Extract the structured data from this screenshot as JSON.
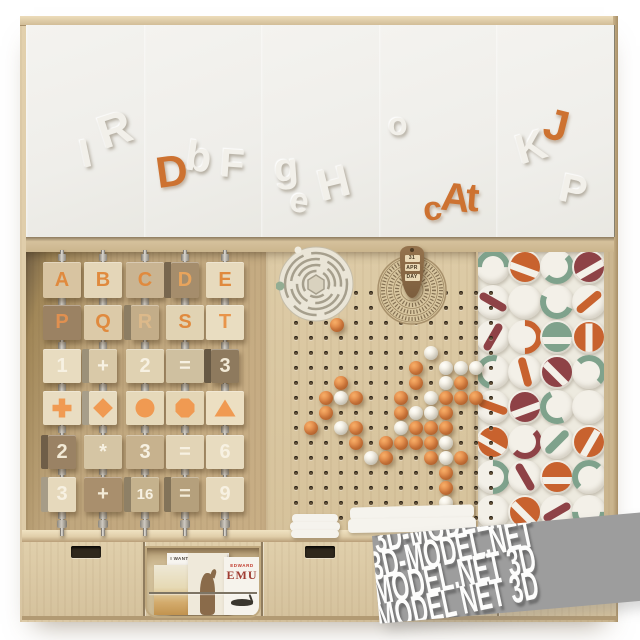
{
  "source_label": "3D-MODEL.NET",
  "watermark": {
    "lines": [
      "T 3D-MODEL.N",
      "3D-MODEL.NET",
      "D-MODEL.NET 3D",
      "MODEL NET 3D"
    ]
  },
  "colors": {
    "accent_orange": "#cd7231",
    "wood_light": "#d6c3a0",
    "wood_mid": "#bfa67d",
    "door_white": "#efeeea",
    "ball_orange": "#dd8040",
    "ball_white": "#efe9da"
  },
  "doors": {
    "count": 5,
    "letters": [
      {
        "ch": "I",
        "x": 80,
        "y": 134,
        "rot": -12,
        "color": "white",
        "size": 40
      },
      {
        "ch": "R",
        "x": 98,
        "y": 106,
        "rot": -18,
        "color": "white",
        "size": 46
      },
      {
        "ch": "D",
        "x": 156,
        "y": 150,
        "rot": -8,
        "color": "orange",
        "size": 44
      },
      {
        "ch": "b",
        "x": 186,
        "y": 136,
        "rot": 8,
        "color": "white",
        "size": 42
      },
      {
        "ch": "F",
        "x": 220,
        "y": 144,
        "rot": 4,
        "color": "white",
        "size": 40
      },
      {
        "ch": "g",
        "x": 274,
        "y": 148,
        "rot": -4,
        "color": "white",
        "size": 40
      },
      {
        "ch": "e",
        "x": 290,
        "y": 184,
        "rot": 10,
        "color": "white",
        "size": 34
      },
      {
        "ch": "H",
        "x": 318,
        "y": 162,
        "rot": -14,
        "color": "white",
        "size": 44
      },
      {
        "ch": "o",
        "x": 388,
        "y": 108,
        "rot": 0,
        "color": "white",
        "size": 32
      },
      {
        "ch": "c",
        "x": 423,
        "y": 192,
        "rot": -6,
        "color": "orange",
        "size": 34
      },
      {
        "ch": "A",
        "x": 441,
        "y": 178,
        "rot": 6,
        "color": "orange",
        "size": 40
      },
      {
        "ch": "t",
        "x": 466,
        "y": 178,
        "rot": 4,
        "color": "orange",
        "size": 40
      },
      {
        "ch": "K",
        "x": 516,
        "y": 126,
        "rot": -16,
        "color": "white",
        "size": 42
      },
      {
        "ch": "J",
        "x": 544,
        "y": 104,
        "rot": 14,
        "color": "orange",
        "size": 44
      },
      {
        "ch": "P",
        "x": 560,
        "y": 170,
        "rot": 12,
        "color": "white",
        "size": 40
      }
    ]
  },
  "abacus": {
    "rod_x": [
      62,
      103,
      145,
      185,
      225
    ],
    "sleeve_y": [
      238,
      282,
      326,
      368,
      410,
      452,
      496
    ],
    "nut_y": 504,
    "shape_color": "#f09a52",
    "rows": [
      {
        "y": 262,
        "h": 36,
        "items": [
          {
            "ch": "A",
            "bg": "#d8c4a1",
            "fg": "#e08a3e"
          },
          {
            "ch": "B",
            "bg": "#e4d6b8",
            "fg": "#e08a3e"
          },
          {
            "ch": "C",
            "bg": "#c9b492",
            "fg": "#e08a3e"
          },
          {
            "ch": "D",
            "bg": "#a58d6c",
            "fg": "#e8a45c",
            "turn": true
          },
          {
            "ch": "E",
            "bg": "#e7dabd",
            "fg": "#e08a3e"
          }
        ]
      },
      {
        "y": 305,
        "h": 35,
        "items": [
          {
            "ch": "P",
            "bg": "#9b8263",
            "fg": "#e09050"
          },
          {
            "ch": "Q",
            "bg": "#dccaa8",
            "fg": "#e08a3e"
          },
          {
            "ch": "R",
            "bg": "#c3ad89",
            "fg": "#dcb98a",
            "turn": true
          },
          {
            "ch": "S",
            "bg": "#e1d3b3",
            "fg": "#e08a3e"
          },
          {
            "ch": "T",
            "bg": "#e9ddc1",
            "fg": "#e8944a"
          }
        ]
      },
      {
        "y": 349,
        "h": 34,
        "items": [
          {
            "ch": "1",
            "bg": "#e8dcc0",
            "fg": "#f7f1e2"
          },
          {
            "ch": "+",
            "bg": "#d9c9a8",
            "fg": "#f7f1e2",
            "turn": true
          },
          {
            "ch": "2",
            "bg": "#e0d2b2",
            "fg": "#f7f1e2"
          },
          {
            "ch": "=",
            "bg": "#cfc0a0",
            "fg": "#f7f1e2"
          },
          {
            "ch": "3",
            "bg": "#8e7a5e",
            "fg": "#f2ead6",
            "turn": true
          }
        ]
      },
      {
        "y": 391,
        "h": 34,
        "items": [
          {
            "shape": "cross",
            "bg": "#e9ddc2"
          },
          {
            "shape": "diamond",
            "bg": "#e8dcc0",
            "turn": true
          },
          {
            "shape": "circle",
            "bg": "#e6d9ba"
          },
          {
            "shape": "octagon",
            "bg": "#e4d6b6"
          },
          {
            "shape": "triangle",
            "bg": "#ecdfc2"
          }
        ]
      },
      {
        "y": 435,
        "h": 34,
        "items": [
          {
            "ch": "2",
            "bg": "#9a8264",
            "fg": "#f2ead6",
            "turn": true
          },
          {
            "ch": "*",
            "bg": "#d5c5a4",
            "fg": "#f7f1e2"
          },
          {
            "ch": "3",
            "bg": "#c7b28e",
            "fg": "#f7f1e2"
          },
          {
            "ch": "=",
            "bg": "#e2d4b6",
            "fg": "#f7f1e2"
          },
          {
            "ch": "6",
            "bg": "#e8dcc0",
            "fg": "#f7f1e2"
          }
        ]
      },
      {
        "y": 477,
        "h": 35,
        "items": [
          {
            "ch": "3",
            "bg": "#e6d9bc",
            "fg": "#f7f1e2",
            "turn": true
          },
          {
            "ch": "+",
            "bg": "#a98f6d",
            "fg": "#f2ead6"
          },
          {
            "ch": "16",
            "bg": "#c5b28d",
            "fg": "#f7f1e2",
            "turn": true,
            "small": true
          },
          {
            "ch": "=",
            "bg": "#b5a07c",
            "fg": "#f2ead6",
            "turn": true
          },
          {
            "ch": "9",
            "bg": "#e6d9bc",
            "fg": "#f7f1e2"
          }
        ]
      }
    ]
  },
  "pegboard": {
    "cols": 14,
    "rows": 16,
    "origin_x": 276,
    "origin_y": 291,
    "spacing": 15,
    "balls": [
      [
        4,
        9,
        "w"
      ],
      [
        5,
        8,
        "o"
      ],
      [
        5,
        10,
        "w"
      ],
      [
        5,
        11,
        "w"
      ],
      [
        5,
        12,
        "w"
      ],
      [
        6,
        3,
        "o"
      ],
      [
        6,
        8,
        "o"
      ],
      [
        6,
        10,
        "w"
      ],
      [
        6,
        11,
        "o"
      ],
      [
        7,
        2,
        "o"
      ],
      [
        7,
        3,
        "w"
      ],
      [
        7,
        4,
        "o"
      ],
      [
        7,
        7,
        "o"
      ],
      [
        7,
        9,
        "w"
      ],
      [
        7,
        10,
        "o"
      ],
      [
        7,
        11,
        "o"
      ],
      [
        7,
        12,
        "o"
      ],
      [
        8,
        2,
        "o"
      ],
      [
        8,
        7,
        "o"
      ],
      [
        8,
        8,
        "w"
      ],
      [
        8,
        9,
        "w"
      ],
      [
        8,
        10,
        "o"
      ],
      [
        9,
        1,
        "o"
      ],
      [
        9,
        3,
        "w"
      ],
      [
        9,
        4,
        "o"
      ],
      [
        9,
        7,
        "w"
      ],
      [
        9,
        8,
        "o"
      ],
      [
        9,
        9,
        "o"
      ],
      [
        9,
        10,
        "o"
      ],
      [
        10,
        4,
        "o"
      ],
      [
        10,
        6,
        "o"
      ],
      [
        10,
        7,
        "o"
      ],
      [
        10,
        8,
        "o"
      ],
      [
        10,
        9,
        "o"
      ],
      [
        10,
        10,
        "w"
      ],
      [
        11,
        5,
        "w"
      ],
      [
        11,
        6,
        "o"
      ],
      [
        11,
        9,
        "o"
      ],
      [
        11,
        10,
        "w"
      ],
      [
        11,
        11,
        "o"
      ],
      [
        12,
        10,
        "o"
      ],
      [
        13,
        10,
        "o"
      ],
      [
        14,
        10,
        "w"
      ]
    ],
    "loose_ball": {
      "x": 330,
      "y": 318,
      "color": "o"
    },
    "green_peg_color": "#93ad93"
  },
  "dial": {
    "windows": [
      "31",
      "APR",
      "DAY"
    ]
  },
  "pattern": {
    "palette": {
      "o": "#c8622e",
      "m": "#8e4246",
      "g": "#7fa28c"
    },
    "cols": 4,
    "rows": 8,
    "cell_w": 32,
    "cell_h": 35,
    "tiles": [
      {
        "t": "arc",
        "c": "g",
        "r": -45
      },
      {
        "t": "disc",
        "c": "o",
        "r": 20
      },
      {
        "t": "arc",
        "c": "g",
        "r": 90
      },
      {
        "t": "disc",
        "c": "m",
        "r": -30
      },
      {
        "t": "bar",
        "c": "m",
        "r": 30
      },
      {
        "t": "plain"
      },
      {
        "t": "arc",
        "c": "g",
        "r": 160
      },
      {
        "t": "bar",
        "c": "o",
        "r": -40
      },
      {
        "t": "bar",
        "c": "m",
        "r": -60
      },
      {
        "t": "arc",
        "c": "o",
        "r": 45
      },
      {
        "t": "disc",
        "c": "g",
        "r": 0
      },
      {
        "t": "disc",
        "c": "o",
        "r": 90
      },
      {
        "t": "arc",
        "c": "g",
        "r": -120
      },
      {
        "t": "bar",
        "c": "o",
        "r": 75
      },
      {
        "t": "disc",
        "c": "m",
        "r": 45
      },
      {
        "t": "arc",
        "c": "g",
        "r": 0
      },
      {
        "t": "bar",
        "c": "o",
        "r": 20
      },
      {
        "t": "disc",
        "c": "m",
        "r": -20
      },
      {
        "t": "arc",
        "c": "g",
        "r": 200
      },
      {
        "t": "plain"
      },
      {
        "t": "disc",
        "c": "o",
        "r": 30
      },
      {
        "t": "arc",
        "c": "m",
        "r": 90
      },
      {
        "t": "bar",
        "c": "g",
        "r": -45
      },
      {
        "t": "disc",
        "c": "o",
        "r": -60
      },
      {
        "t": "arc",
        "c": "g",
        "r": 45
      },
      {
        "t": "bar",
        "c": "m",
        "r": 60
      },
      {
        "t": "disc",
        "c": "o",
        "r": 0
      },
      {
        "t": "arc",
        "c": "g",
        "r": -90
      },
      {
        "t": "plain"
      },
      {
        "t": "disc",
        "c": "o",
        "r": 45
      },
      {
        "t": "bar",
        "c": "m",
        "r": -30
      },
      {
        "t": "arc",
        "c": "g",
        "r": 135
      }
    ]
  },
  "shelf": {
    "books": [
      {
        "title": "I WANT MY HAT BACK"
      },
      {
        "title_top": "EDWARD",
        "title_main": "EMU"
      }
    ]
  }
}
